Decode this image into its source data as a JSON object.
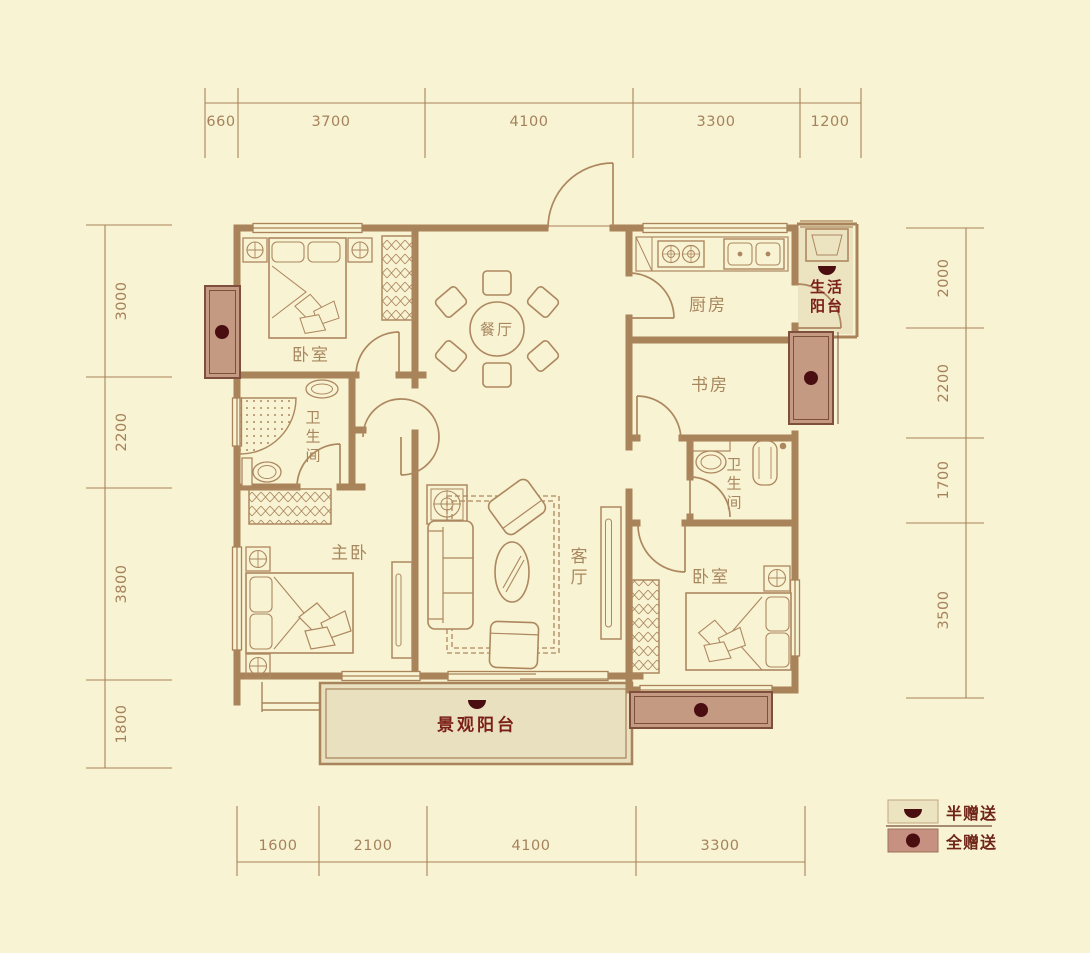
{
  "colors": {
    "background": "#f8f3d2",
    "wall": "#a9835a",
    "furniture_line": "#ad8760",
    "dimension_text": "#a5825c",
    "room_text": "#a8875f",
    "accent_red_text": "#7b2018",
    "bay_fill": "#c49a82",
    "bay_stroke": "#7d4f3c",
    "gift_dot": "#4a0d10",
    "half_gift_fill": "#ece3c1",
    "view_balcony_fill": "#e9e0bf",
    "full_gift_swatch": "#c69181"
  },
  "dimensions": {
    "top": [
      "660",
      "3700",
      "4100",
      "3300",
      "1200"
    ],
    "bottom": [
      "1600",
      "2100",
      "4100",
      "3300"
    ],
    "left": [
      "3000",
      "2200",
      "3800",
      "1800"
    ],
    "right": [
      "2000",
      "2200",
      "1700",
      "3500"
    ]
  },
  "rooms": {
    "bedroom_top_left": "卧室",
    "dining": "餐厅",
    "kitchen": "厨房",
    "service_balcony_line1": "生活",
    "service_balcony_line2": "阳台",
    "study": "书房",
    "bathroom_left": "卫生间",
    "bathroom_right": "卫生间",
    "master_bedroom": "主卧",
    "living_room": "客厅",
    "bedroom_bottom_right": "卧室",
    "view_balcony": "景观阳台"
  },
  "legend": {
    "half_gift": "半赠送",
    "full_gift": "全赠送",
    "half_gift_icon": "half-circle-down",
    "full_gift_icon": "filled-circle"
  }
}
